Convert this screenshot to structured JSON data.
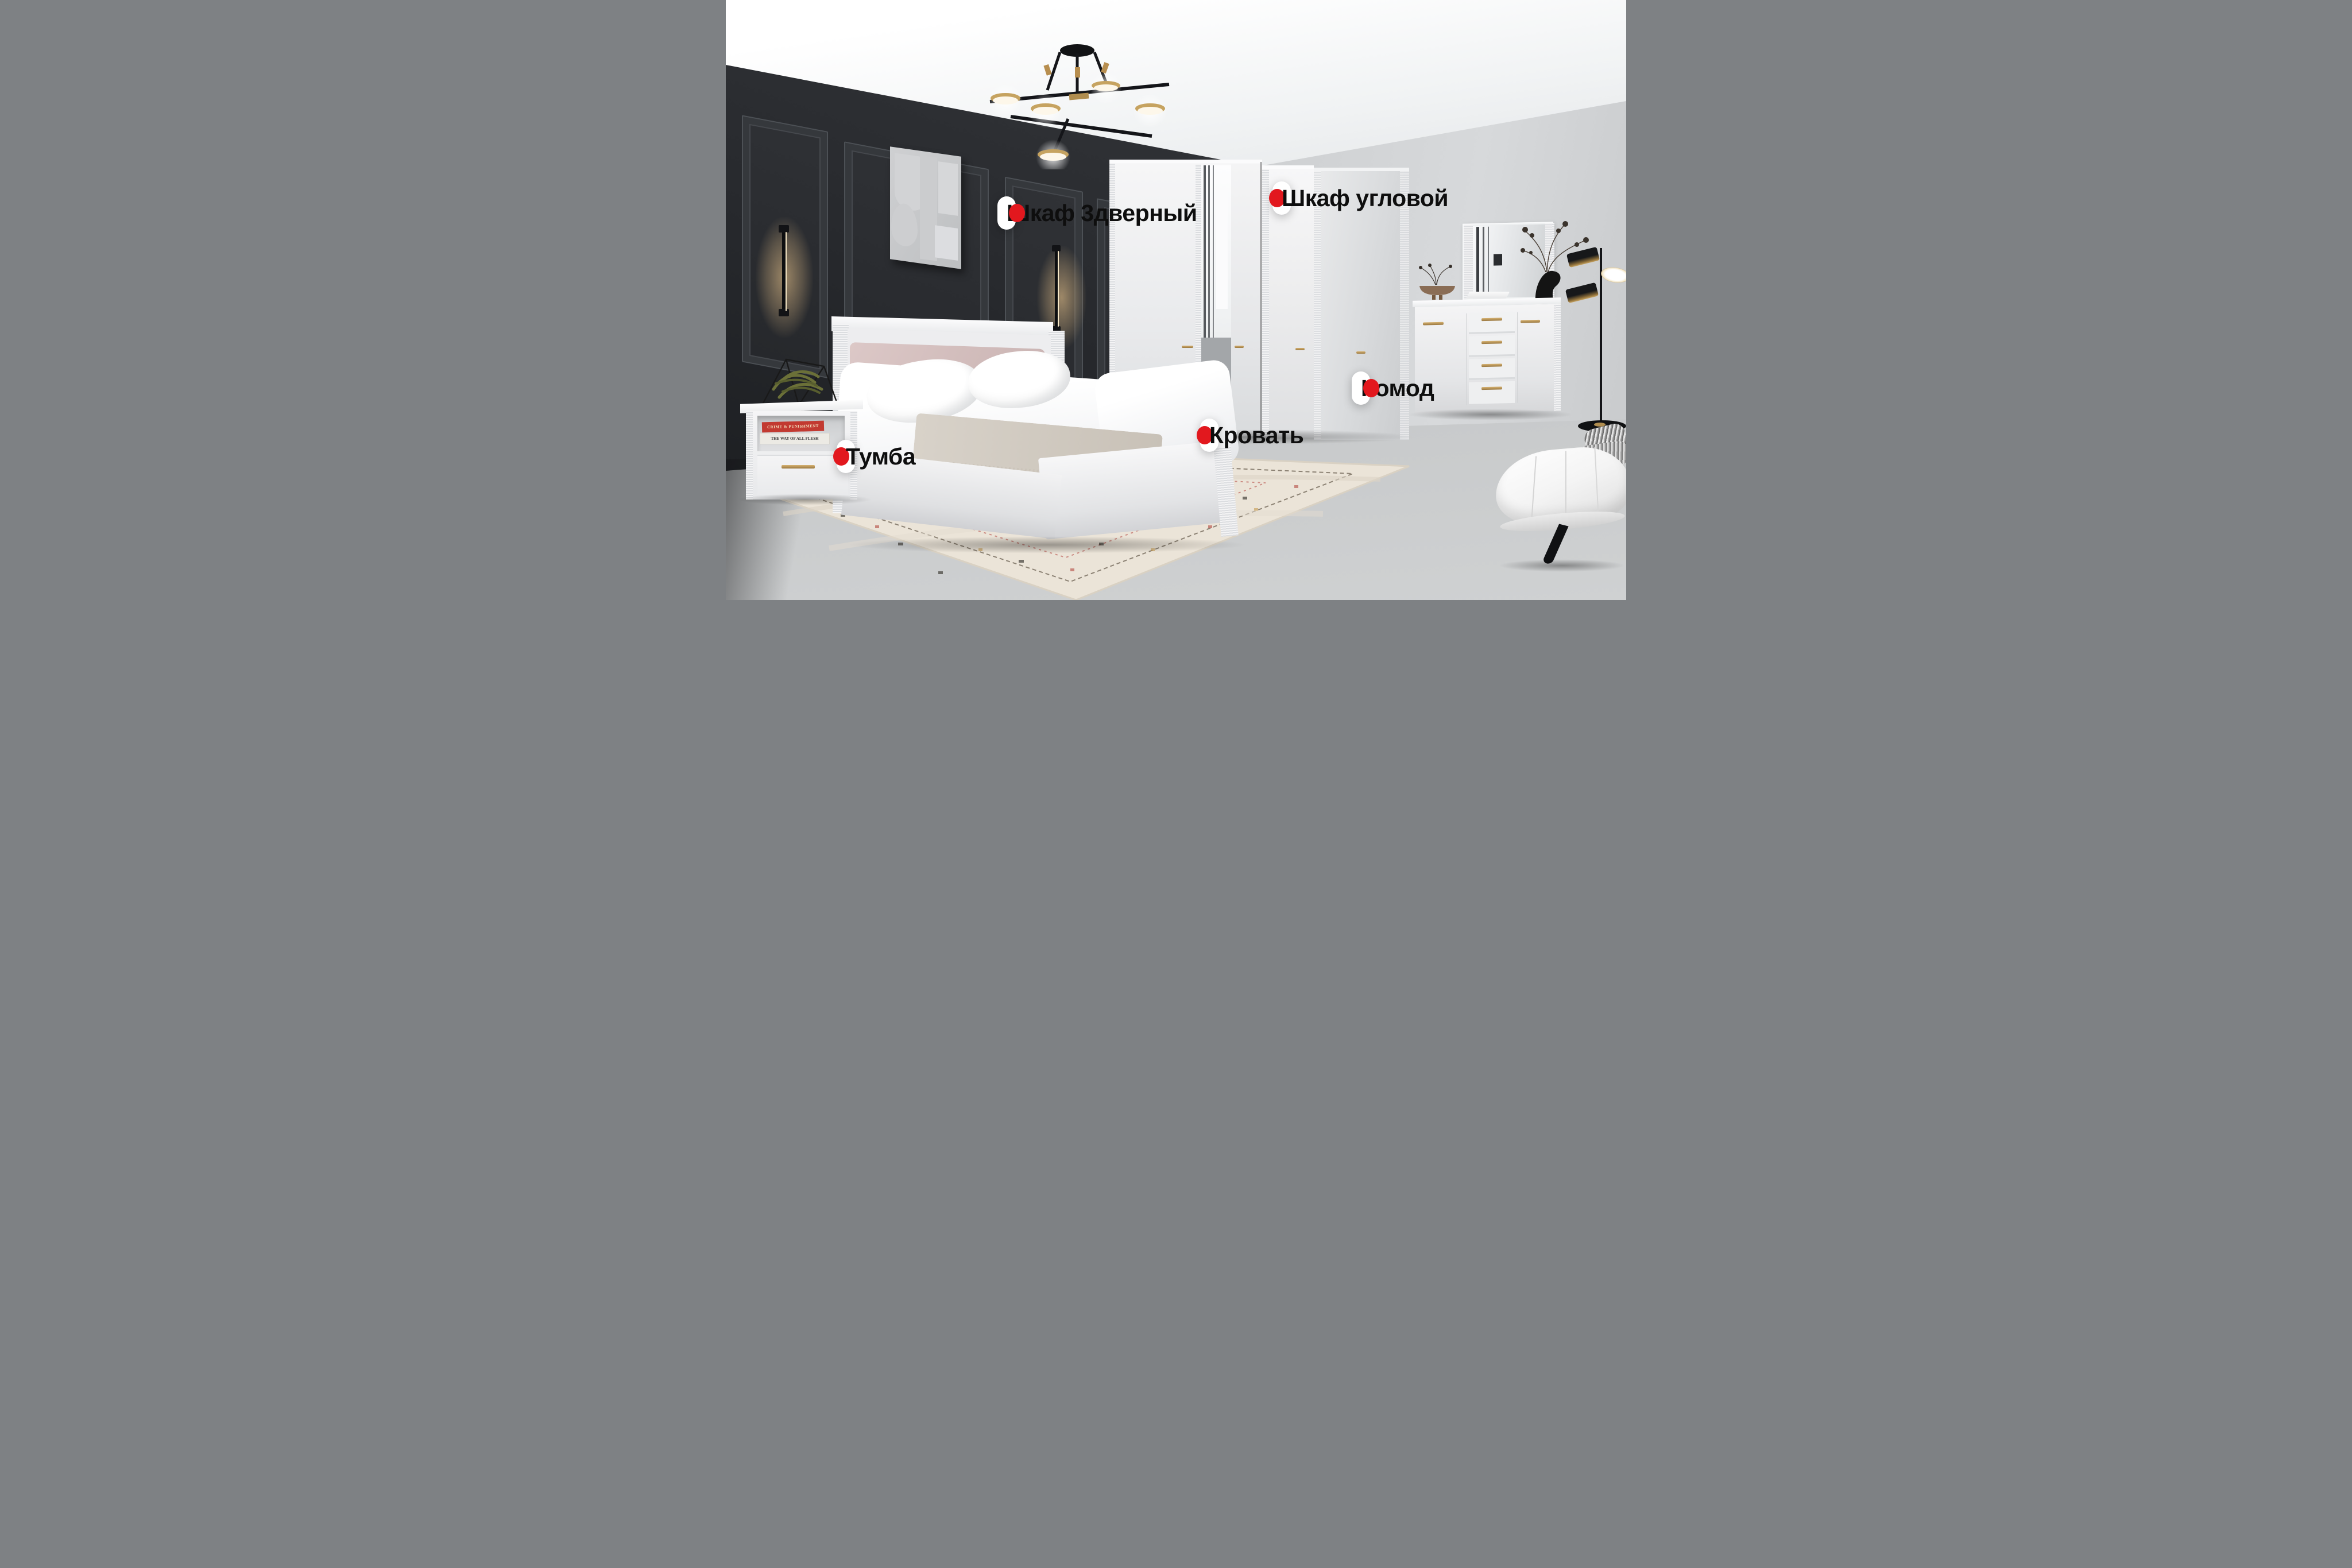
{
  "annotations": {
    "marker_color": "#e2181e",
    "label_background": "#ffffff",
    "label_text_color": "#0e0e0e",
    "labels": [
      {
        "id": "wardrobe-3door",
        "text": "Шкаф 3дверный",
        "marker_side": "right"
      },
      {
        "id": "wardrobe-corner",
        "text": "Шкаф угловой",
        "marker_side": "left"
      },
      {
        "id": "dresser",
        "text": "Комод",
        "marker_side": "right"
      },
      {
        "id": "bed",
        "text": "Кровать",
        "marker_side": "left"
      },
      {
        "id": "nightstand",
        "text": "Тумба",
        "marker_side": "left"
      }
    ]
  },
  "scene": {
    "books": [
      {
        "title": "CRIME & PUNISHMENT",
        "spine_color": "#c23a31"
      },
      {
        "title": "THE WAY OF ALL FLESH",
        "author": "Samuel Butler",
        "spine_color": "#eceae4"
      }
    ],
    "palette": {
      "dark_wall": "#2b2d31",
      "light_wall": "#c6c8ca",
      "floor": "#c0c2c3",
      "ceiling": "#f5f6f7",
      "furniture_white": "#f2f3f5",
      "brass": "#b78e4f",
      "headboard_pink": "#d2bdbc",
      "rug": "#ebe4d8",
      "marker_red": "#e2181e"
    }
  }
}
